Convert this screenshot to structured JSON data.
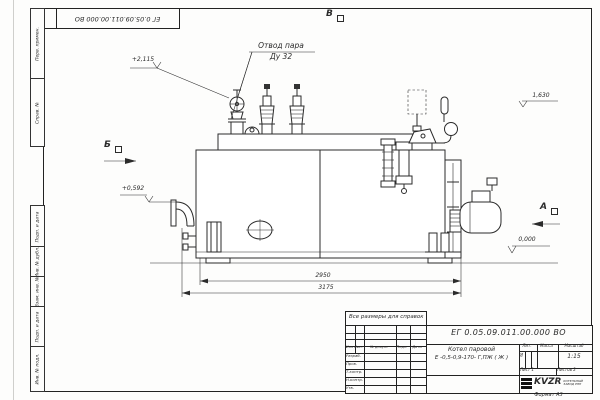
{
  "drawing": {
    "designation": "ЕГ 0.05.09.011.00.000  ВО",
    "corner_designation": "ЕГ 0.05.09.011.00.000  ВО",
    "note": "Все размеры для справок",
    "format_label": "Формат А3",
    "line_color": "#2b2b2b"
  },
  "callouts": {
    "steam_outlet_line1": "Отвод пара",
    "steam_outlet_line2": "Ду 32",
    "elev_top": "+2,115",
    "elev_front": "+0,592",
    "elev_right": "1,630",
    "elev_zero": "0,000"
  },
  "dimensions": {
    "length_inner": "2950",
    "length_overall": "3175"
  },
  "views": {
    "a": "А",
    "b": "Б",
    "v": "В"
  },
  "title_block": {
    "product_title": "Котел паровой",
    "product_model": "Е -0,5-0,9-170- Г,ПЖ ( Ж )",
    "col_lit": "Лит.",
    "col_mass": "Масса",
    "col_scale": "Масштаб",
    "lit_value": "И",
    "scale_value": "1:15",
    "sheet_label": "Лист",
    "sheet_value": "1",
    "sheets_label": "Листов",
    "sheets_value": "2",
    "header_cols": [
      "Изм",
      "Лист",
      "№ докум.",
      "Подп.",
      "Дата"
    ],
    "row_labels": [
      "Разраб.",
      "Пров.",
      "Т.контр.",
      "Н.контр.",
      "Утв."
    ],
    "logo_text": "KVZR",
    "logo_sub1": "КОТЕЛЬНЫЙ",
    "logo_sub2": "ЗАВОД РЭП"
  },
  "margin_stamps": [
    "Перв. примен.",
    "Справ. №",
    "Подп. и дата",
    "Инв. № дубл.",
    "Взам. инв. №",
    "Подп. и дата",
    "Инв. № подл."
  ]
}
